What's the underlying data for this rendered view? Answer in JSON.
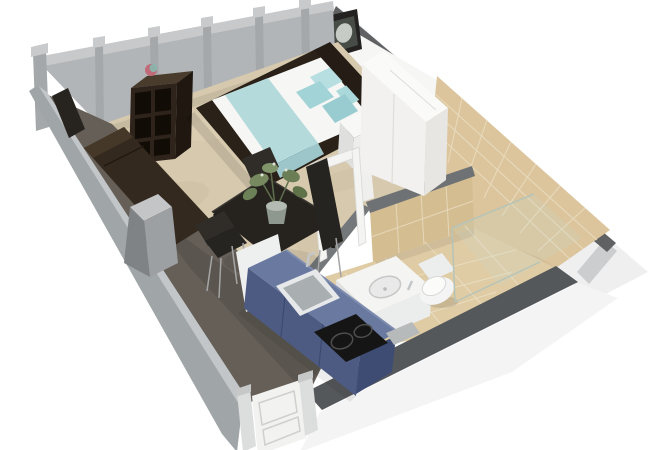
{
  "meta": {
    "view": "3d-floorplan-cutaway-render",
    "apartment_type": "studio-apartment"
  },
  "scene": {
    "rooms": [
      {
        "name": "living-sleeping-area",
        "floor": "beige-carpet"
      },
      {
        "name": "bathroom",
        "floor": "beige-tile",
        "walls": "beige-tile"
      },
      {
        "name": "kitchenette",
        "location": "along-front-wall"
      }
    ],
    "furniture": [
      "glass-window-wall",
      "double-bed",
      "teal-pillows",
      "teal-bed-runner",
      "headboard",
      "nightstand",
      "white-wardrobe",
      "wall-picture",
      "cube-shelf",
      "decor-ball",
      "tv-panel",
      "dark-sofa",
      "gray-side-pedestal",
      "dining-table",
      "dining-chairs",
      "potted-plant",
      "blue-kitchen-counter",
      "kitchen-sink",
      "induction-cooktop",
      "white-appliance",
      "bathroom-vanity-sink",
      "toilet",
      "shower-glass-screen",
      "bathroom-door-frame",
      "entrance-door"
    ]
  },
  "palette": {
    "bg": "#ffffff",
    "glass": "#b2b5b7",
    "glassTopRail": "#c7c9ca",
    "glassBase": "#8c9092",
    "post": "#a4a8aa",
    "postCap": "#c8cacb",
    "capDark": "#5f6163",
    "wallExt": "#efefef",
    "wallSliver": "#cbcdce",
    "wallWhiteInt": "#f6f6f5",
    "tileWall": "#dcc59c",
    "tileWallShade": "rgba(120,95,55,0.12)",
    "tileGrout": "#eadfc4",
    "partCap": "#6f7274",
    "partTile": "#d5bd92",
    "partEnd": "#75787a",
    "partWhite": "#efefed",
    "bathFloor": "#dfcba4",
    "frontRightBand": "#55585b",
    "frontRightExt": "#f4f4f4",
    "frontLeftInner": "#655f58",
    "frontLeftEdge": "#c3c6c8",
    "frontLeftExt": "#a0a5a7",
    "carpet": "#d6c9ae",
    "carpetBlobA": "#c9bb9e",
    "carpetBlobB": "#e0d4ba",
    "carpetBlobC": "#cfc1a4",
    "doorPost": "#dcdddd",
    "doorPostCap": "#c6c8c8",
    "doorWhite": "#f2f2f1",
    "doorLine": "#cfcfce",
    "bathFrame": "#f4f4f2",
    "bathFrameEdge": "#d8d8d6",
    "tv": "#27231f",
    "shelfTop": "#493c2d",
    "shelfFront": "#2e241b",
    "shelfSide": "#1f1710",
    "cubby": "#120c06",
    "ballPink": "#c06a78",
    "ballTeal": "#87b9ad",
    "sofa": "#34291f",
    "sofaHi": "#453828",
    "pedTop": "#c3c5c6",
    "pedFront": "#9da0a2",
    "pedSide": "#808385",
    "bedBase": "#2a2219",
    "mattress": "#f6f6f4",
    "blanket": "#b5dadc",
    "blanketDrape": "#9cc6c9",
    "pillowA": "#b7dfe2",
    "pillowB": "#abd8db",
    "pillowC": "#a2d3d7",
    "pillowD": "#98ccd1",
    "headboard": "#251c15",
    "nightTop": "#f8f8f7",
    "nightFront": "#ededeb",
    "nightSide": "#dfdfdd",
    "seam": "#deddd9",
    "wardTop": "#fafaf9",
    "wardFront": "#f2f1ef",
    "wardSide": "#e7e6e3",
    "picFrame": "#242220",
    "picMat": "#474c47",
    "flower": "#c6ccc5",
    "stem": "#5d6f4c",
    "leafA": "#76895f",
    "leafB": "#6a7d54",
    "leafC": "#81956b",
    "leafD": "#5f7249",
    "leafE": "#6d8158",
    "flowerDot": "#dfe6da",
    "potTop": "#b4bbb2",
    "potBody": "#8f988e",
    "tableTop": "#26231f",
    "tableEdge": "#3b3834",
    "tableLeg": "#1b1916",
    "chair": "#302d28",
    "chairDark": "#262420",
    "chairLeg": "#a5a5a5",
    "fridge": "#eef0f0",
    "counterFront": "#4d5b83",
    "counterEnd": "#3e4c73",
    "counterTop": "#69799f",
    "counterEdge": "#7e8daf",
    "counterSeam": "#3b4a6f",
    "sinkRim": "#e6e8e9",
    "sinkInner": "#a9aeb1",
    "faucet": "#c4c7c9",
    "hob": "#151515",
    "hobRing": "#4d4d4d",
    "tray": "#b7babb",
    "bathSide": "#dfe0df",
    "bathFrontFace": "#ebecec",
    "bathTop": "#f4f4f3",
    "bowl": "#e8e9e8",
    "bowlEdge": "#c6c8c7",
    "toiletTank": "#eceded",
    "toiletBowl": "#f3f4f3",
    "toiletSeat": "#fbfbfa",
    "toiletSeatEdge": "#d8d9d8",
    "showerGlass": "rgba(200,218,205,0.22)",
    "showerEdge": "#b6c4b8",
    "shadow": "rgba(0,0,0,0.10)",
    "shadowSoft": "rgba(0,0,0,0.07)"
  }
}
